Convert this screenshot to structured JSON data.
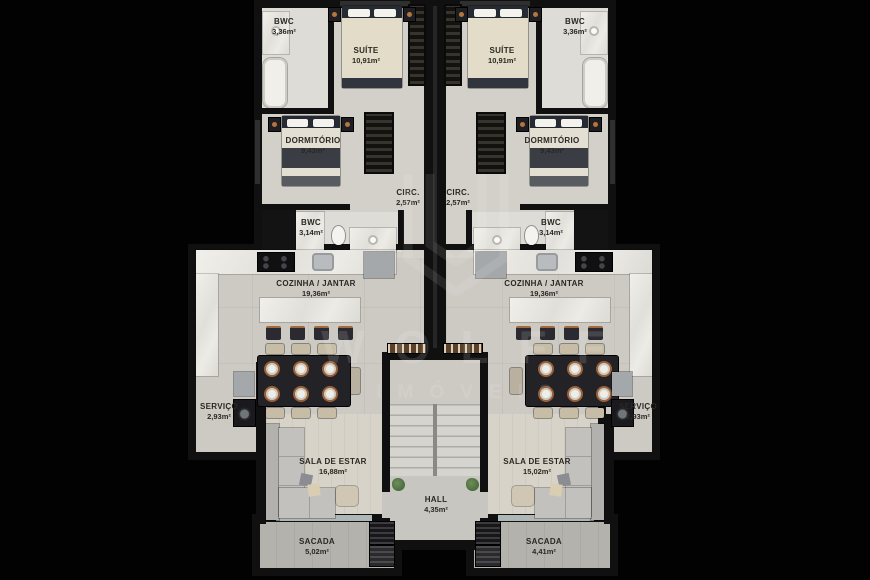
{
  "watermark": {
    "brand": "WOLFF",
    "tagline": "IMÓVEIS"
  },
  "hall": {
    "label": "HALL",
    "area": "4,35m²"
  },
  "units": {
    "left": {
      "bwc_suite": {
        "label": "BWC",
        "area": "3,36m²"
      },
      "suite": {
        "label": "SUÍTE",
        "area": "10,91m²"
      },
      "dormitorio": {
        "label": "DORMITÓRIO",
        "area": "9,43m²"
      },
      "circ": {
        "label": "CIRC.",
        "area": "2,57m²"
      },
      "bwc_social": {
        "label": "BWC",
        "area": "3,14m²"
      },
      "cozinha_jantar": {
        "label": "COZINHA / JANTAR",
        "area": "19,36m²"
      },
      "servico": {
        "label": "SERVIÇO",
        "area": "2,93m²"
      },
      "sala_estar": {
        "label": "SALA DE ESTAR",
        "area": "16,88m²"
      },
      "sacada": {
        "label": "SACADA",
        "area": "5,02m²"
      }
    },
    "right": {
      "bwc_suite": {
        "label": "BWC",
        "area": "3,36m²"
      },
      "suite": {
        "label": "SUÍTE",
        "area": "10,91m²"
      },
      "dormitorio": {
        "label": "DORMITÓRIO",
        "area": "9,43m²"
      },
      "circ": {
        "label": "CIRC.",
        "area": "2,57m²"
      },
      "bwc_social": {
        "label": "BWC",
        "area": "3,14m²"
      },
      "cozinha_jantar": {
        "label": "COZINHA / JANTAR",
        "area": "19,36m²"
      },
      "servico": {
        "label": "SERVIÇO",
        "area": "2,93m²"
      },
      "sala_estar": {
        "label": "SALA DE ESTAR",
        "area": "15,02m²"
      },
      "sacada": {
        "label": "SACADA",
        "area": "4,41m²"
      }
    }
  }
}
